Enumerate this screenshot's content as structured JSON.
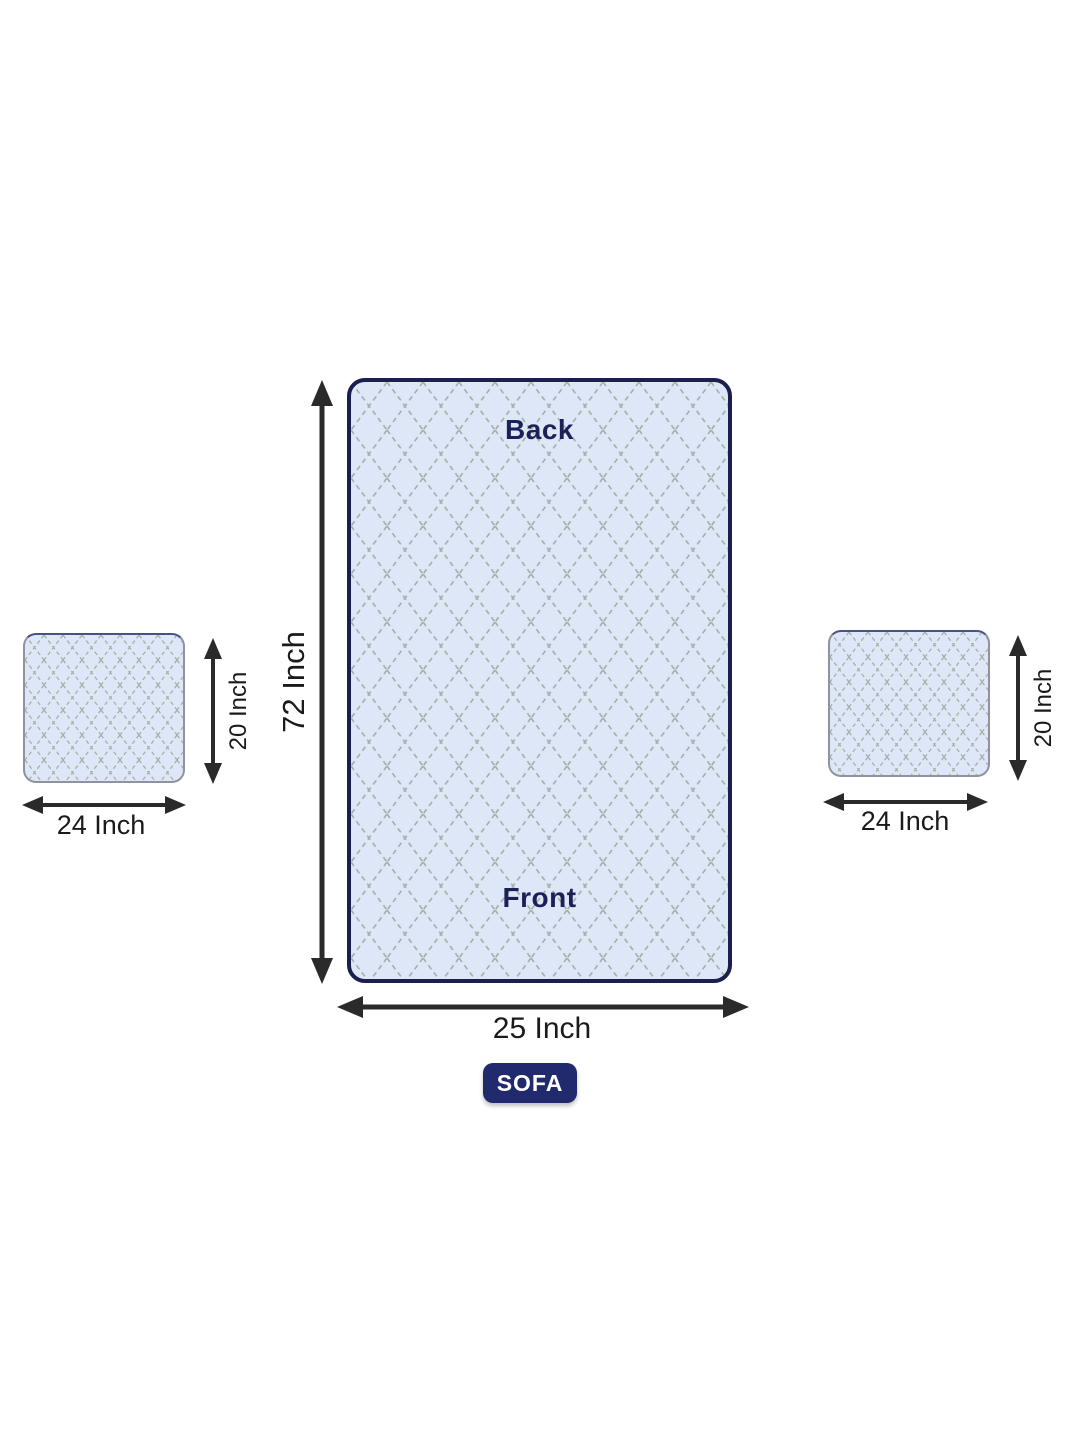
{
  "diagram_title": "Sofa cover dimension diagram",
  "sofa_panel": {
    "back_label": "Back",
    "front_label": "Front",
    "height_dim": "72 Inch",
    "width_dim": "25 Inch",
    "badge": "SOFA"
  },
  "left_cushion": {
    "height_dim": "20 Inch",
    "width_dim": "24 Inch"
  },
  "right_cushion": {
    "height_dim": "20 Inch",
    "width_dim": "24 Inch"
  },
  "colors": {
    "background": "#ffffff",
    "quilt_fill": "#dde7f7",
    "quilt_line": "#a6b1a8",
    "panel_border": "#191f4e",
    "cushion_border": "#8d93a1",
    "arrow": "#2a2a2a",
    "panel_text": "#1b2158",
    "dimension_text": "#1a1a1a",
    "badge_background": "#202a6d",
    "badge_text": "#ffffff"
  }
}
